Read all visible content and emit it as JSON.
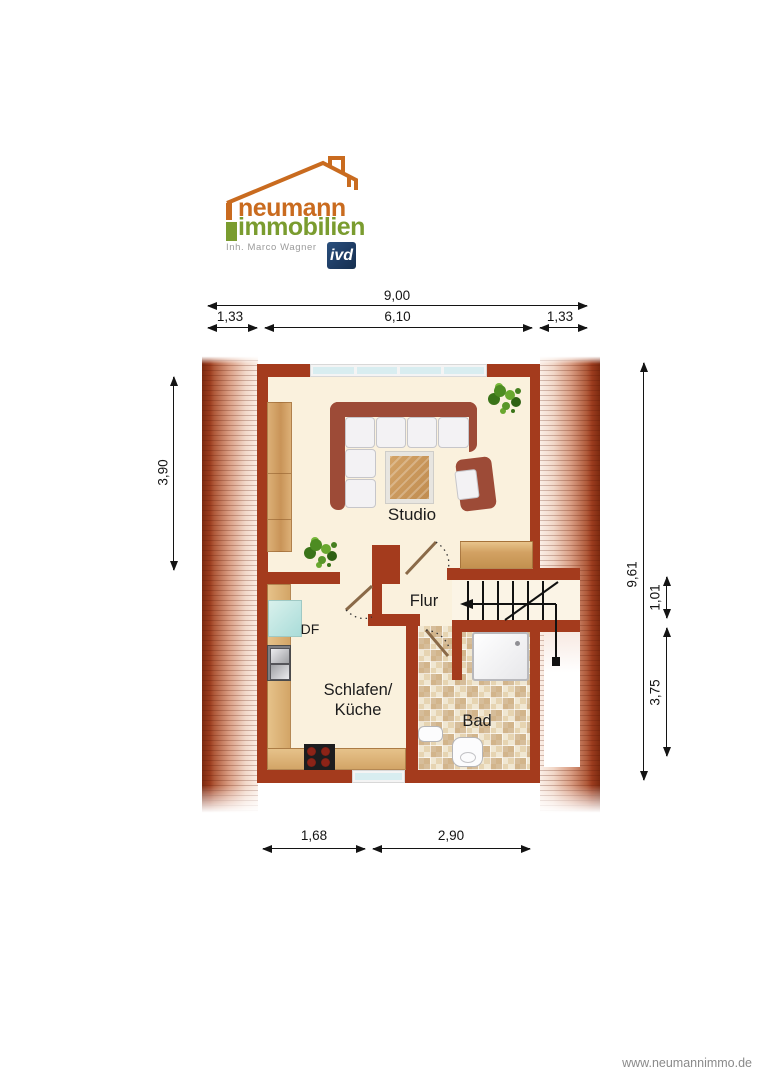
{
  "logo": {
    "brand_top": "neumann",
    "brand_bottom": "immobilien",
    "owner": "Inh. Marco Wagner",
    "badge": "ivd"
  },
  "rooms": {
    "studio": "Studio",
    "flur": "Flur",
    "sleep_line1": "Schlafen/",
    "sleep_line2": "Küche",
    "bad": "Bad",
    "df": "DF"
  },
  "dimensions": {
    "total_width": "9,00",
    "left_offset": "1,33",
    "inner_width": "6,10",
    "right_offset": "1,33",
    "left_height": "3,90",
    "total_height": "9,61",
    "stair_depth": "1,01",
    "lower_height": "3,75",
    "bottom_left": "1,68",
    "bottom_right": "2,90"
  },
  "footer": {
    "website": "www.neumannimmo.de"
  },
  "colors": {
    "wall": "#a43b1d",
    "floor": "#faf1dd",
    "logo_orange": "#c96b1f",
    "logo_green": "#7a9c2f",
    "ivd_blue": "#1e3c64",
    "window_glass": "#d8edf0"
  }
}
